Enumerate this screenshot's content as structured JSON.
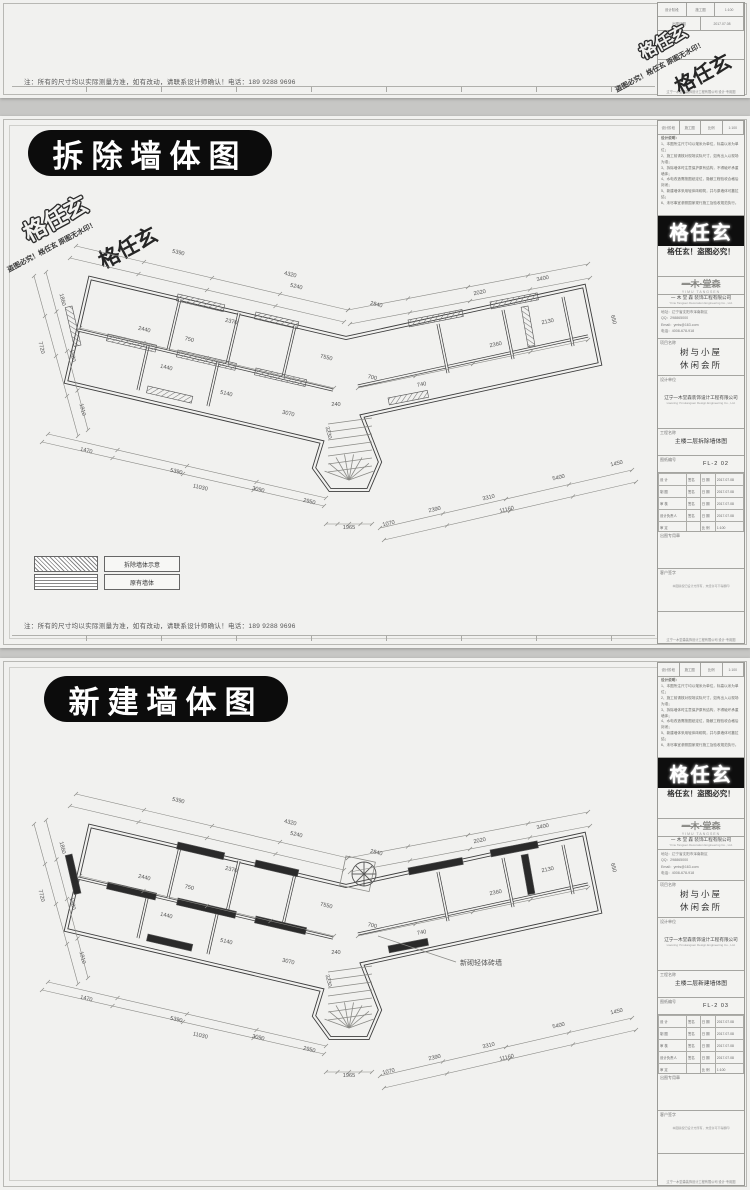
{
  "page": {
    "bg": "#c7c7c5",
    "paper": "#f1f1ef",
    "ink": "#2c2c2c",
    "pill_bg": "#0c0c0c",
    "pill_fg": "#ffffff"
  },
  "watermark": {
    "brand": "格任玄",
    "warning": "盗图必究！格任玄 原图无水印！"
  },
  "shared_note": "注：所有的尺寸均以实际测量为准，如有改动，请联系设计师确认！电话：189 9288 9696",
  "panels": {
    "top": {
      "visible": "bottom-strip-only"
    },
    "demolition": {
      "title": "拆除墙体图",
      "drawing_name": "主楼二层拆除墙体图",
      "drawing_no": "FL-2 02",
      "legend": [
        {
          "swatch": "diagonal-hatch",
          "label": "拆除墙体示意"
        },
        {
          "swatch": "grid-hatch",
          "label": "原有墙体"
        }
      ]
    },
    "new": {
      "title": "新建墙体图",
      "drawing_name": "主楼二层新建墙体图",
      "drawing_no": "FL-2 03",
      "wall_label": "新砌轻体砖墙"
    }
  },
  "titleblock": {
    "head_rows_top": [
      "设计阶段",
      "施工图",
      "比例",
      "1:100"
    ],
    "head_rows_bottom": [
      "出图日期",
      "2017.07.08"
    ],
    "notes_title": "设计说明：",
    "notes_lines": [
      "1、本图所注尺寸均以毫米为单位，标高以米为单位；",
      "2、施工前请核对现场实际尺寸，如有出入以现场为准；",
      "3、拆除墙体时注意保护原有结构，不得破坏承重墙体；",
      "4、水电改造需按图纸定位，隐蔽工程验收合格后封闭；",
      "5、新建墙体采用轻体砖砌筑，并与原墙体可靠拉结；",
      "6、未尽事宜参照国家现行施工及验收规范执行。"
    ],
    "brand": "格任玄",
    "anti_piracy": "格任玄！盗图必究！",
    "logo": "一木·堂森",
    "logo_sub": "YIMU TANGSEN",
    "company": "一 木 堂 森  装饰工程有限公司",
    "company_en": "Yimu Tangsen Decoration Engineering Co., Ltd.",
    "contact_lines": [
      "地址：辽宁省沈阳市浑南新区",
      "QQ：298865000",
      "Email：ymts@163.com",
      "电话：4008-678-918"
    ],
    "project_label": "项目名称",
    "project_line1": "树与小屋",
    "project_line2": "休闲会所",
    "design_label": "设计单位",
    "design_company": "辽宁一木堂森装饰设计工程有限公司",
    "design_company_en": "Liaoning Yimutangsen Design Engineering Co., Ltd.",
    "name_label": "工程名称",
    "no_label": "图纸编号",
    "sign_rows": [
      [
        "设  计",
        "签名",
        "日 期",
        "2017.07.08"
      ],
      [
        "制  图",
        "签名",
        "日 期",
        "2017.07.08"
      ],
      [
        "审  核",
        "签名",
        "日 期",
        "2017.07.08"
      ],
      [
        "设计负责人",
        "签名",
        "日 期",
        "2017.07.08"
      ],
      [
        "审  定",
        "",
        "比 例",
        "1:100"
      ]
    ],
    "misc1_label": "出图专用章",
    "misc2_label": "客户签字",
    "footer": "辽宁一木堂森装饰设计工程有限公司  设计·专用图",
    "copyright": "本图版权归设计方所有，未经许可不得翻印"
  },
  "plan_dims": [
    {
      "t": "5390",
      "x": 150,
      "y": 26,
      "r": 13
    },
    {
      "t": "4320",
      "x": 262,
      "y": 48,
      "r": 13
    },
    {
      "t": "5240",
      "x": 268,
      "y": 60,
      "r": 13
    },
    {
      "t": "2840",
      "x": 348,
      "y": 78,
      "r": 13
    },
    {
      "t": "2020",
      "x": 452,
      "y": 66,
      "r": -11
    },
    {
      "t": "3400",
      "x": 515,
      "y": 52,
      "r": -11
    },
    {
      "t": "650",
      "x": 584,
      "y": 92,
      "r": 76
    },
    {
      "t": "7720",
      "x": 12,
      "y": 120,
      "r": 76
    },
    {
      "t": "1860",
      "x": 33,
      "y": 72,
      "r": 76
    },
    {
      "t": "1980",
      "x": 43,
      "y": 128,
      "r": 76
    },
    {
      "t": "1910",
      "x": 53,
      "y": 182,
      "r": 76
    },
    {
      "t": "1470",
      "x": 58,
      "y": 224,
      "r": 13
    },
    {
      "t": "5390",
      "x": 148,
      "y": 245,
      "r": 13
    },
    {
      "t": "3090",
      "x": 230,
      "y": 263,
      "r": 13
    },
    {
      "t": "2950",
      "x": 281,
      "y": 275,
      "r": 13
    },
    {
      "t": "11030",
      "x": 172,
      "y": 261,
      "r": 13
    },
    {
      "t": "1070",
      "x": 361,
      "y": 297,
      "r": -13
    },
    {
      "t": "2390",
      "x": 407,
      "y": 283,
      "r": -13
    },
    {
      "t": "3310",
      "x": 461,
      "y": 271,
      "r": -13
    },
    {
      "t": "11160",
      "x": 479,
      "y": 283,
      "r": -13
    },
    {
      "t": "5400",
      "x": 531,
      "y": 251,
      "r": -13
    },
    {
      "t": "1450",
      "x": 589,
      "y": 237,
      "r": -13
    },
    {
      "t": "1965",
      "x": 321,
      "y": 301,
      "r": 0
    },
    {
      "t": "240",
      "x": 308,
      "y": 178,
      "r": 0
    },
    {
      "t": "2440",
      "x": 116,
      "y": 103,
      "r": 13
    },
    {
      "t": "750",
      "x": 161,
      "y": 113,
      "r": 13
    },
    {
      "t": "2370",
      "x": 203,
      "y": 95,
      "r": 13
    },
    {
      "t": "7550",
      "x": 298,
      "y": 131,
      "r": 13
    },
    {
      "t": "1440",
      "x": 138,
      "y": 141,
      "r": 13
    },
    {
      "t": "700",
      "x": 344,
      "y": 151,
      "r": 13
    },
    {
      "t": "5140",
      "x": 198,
      "y": 167,
      "r": 13
    },
    {
      "t": "3070",
      "x": 260,
      "y": 187,
      "r": 13
    },
    {
      "t": "3230",
      "x": 299,
      "y": 205,
      "r": 76
    },
    {
      "t": "740",
      "x": 394,
      "y": 158,
      "r": -11
    },
    {
      "t": "2360",
      "x": 468,
      "y": 118,
      "r": -11
    },
    {
      "t": "2130",
      "x": 520,
      "y": 95,
      "r": -11
    }
  ]
}
